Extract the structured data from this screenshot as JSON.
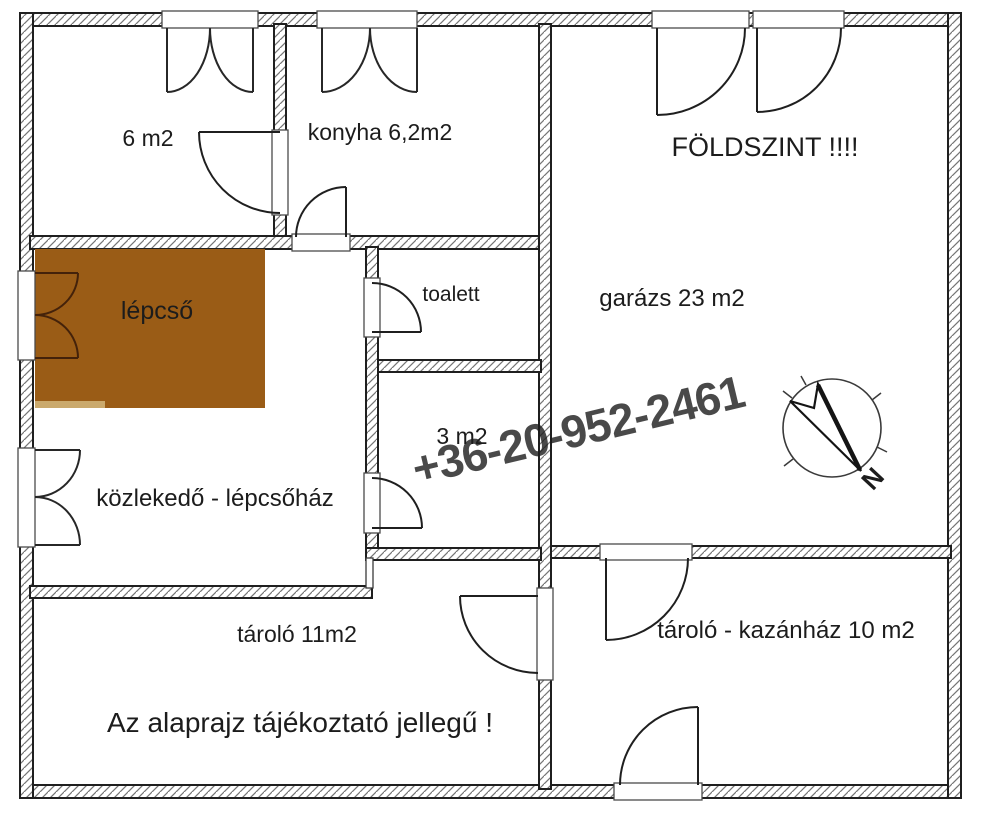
{
  "plan": {
    "floor_title": "FÖLDSZINT !!!!",
    "watermark_phone": "+36-20-952-2461",
    "disclaimer": "Az alaprajz tájékoztató jellegű !",
    "compass_north_letter": "N",
    "rooms": {
      "small_room": "6 m2",
      "kitchen": "konyha 6,2m2",
      "garage": "garázs 23 m2",
      "stairs": "lépcső",
      "toilet": "toalett",
      "small_wc_room": "3 m2",
      "hallway": "közlekedő - lépcsőház",
      "storage": "tároló 11m2",
      "boiler_storage": "tároló - kazánház 10 m2"
    },
    "colors": {
      "stairs_fill": "#9a5c16",
      "stairs_edge": "#caa96c",
      "stairs_text": "#3d2103",
      "wall_line": "#1f1f1f",
      "hatch_line": "#757575",
      "watermark": "#aeaeae",
      "background": "#ffffff"
    }
  }
}
